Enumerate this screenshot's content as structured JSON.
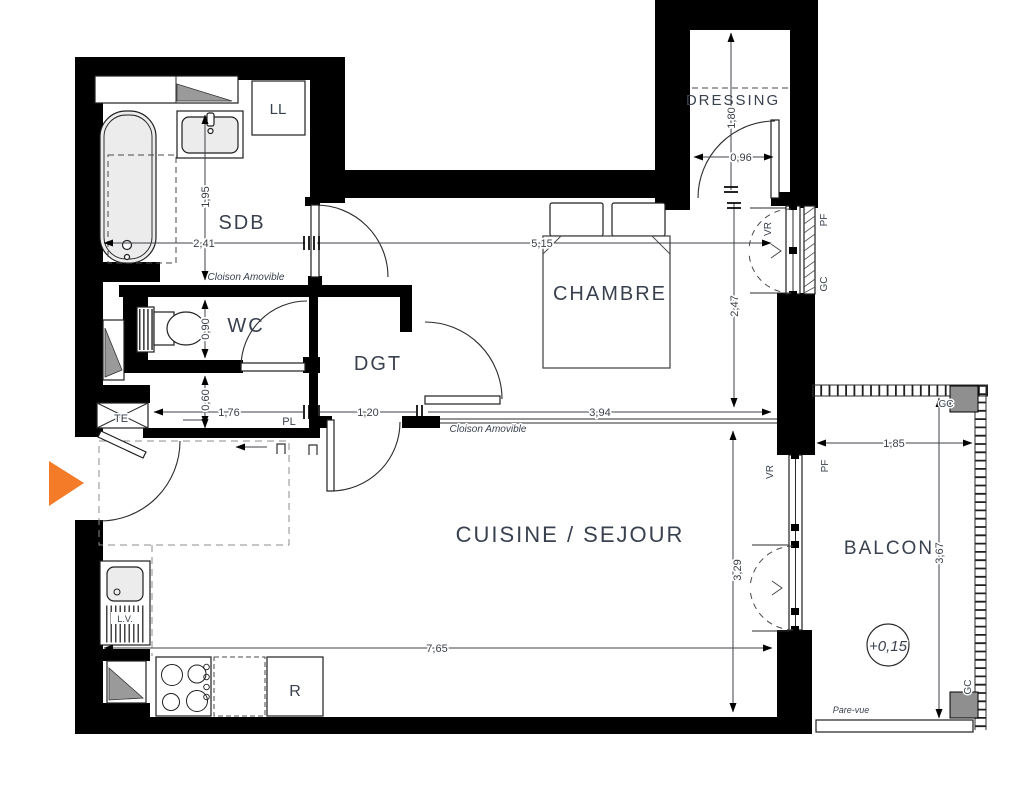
{
  "colors": {
    "wall": "#000000",
    "entry_arrow": "#f47c28",
    "fixture_fill": "#ececec",
    "shaft_fill": "#9a9a9a",
    "post_fill": "#8f8f8f",
    "text": "#39414f",
    "dim_text": "#3a3f47"
  },
  "rooms": {
    "sdb": "SDB",
    "wc": "WC",
    "dgt": "DGT",
    "chambre": "CHAMBRE",
    "dressing": "DRESSING",
    "cuisine_sejour": "CUISINE / SEJOUR",
    "balcon": "BALCON"
  },
  "equipment": {
    "washing_machine": "LL",
    "dishwasher": "L.V.",
    "fridge": "R",
    "electrical_panel": "TE",
    "closet": "PL"
  },
  "openings": {
    "roller_shutter": "VR",
    "french_window": "PF",
    "guardrail": "GC"
  },
  "partitions": {
    "removable_partition": "Cloison Amovible",
    "privacy_screen": "Pare-vue"
  },
  "levels": {
    "balcony_level": "+0,15"
  },
  "dimensions": {
    "sdb_width": "2,41",
    "sdb_depth": "1,95",
    "wc_depth": "0,90",
    "entry_closet_depth": "0,60",
    "entry_closet_width": "1,76",
    "dgt_width": "1,20",
    "chambre_width": "5,15",
    "chambre_depth": "2,47",
    "chambre_south_width": "3,94",
    "dressing_depth": "1,80",
    "dressing_width": "0,96",
    "cuisine_width": "7,65",
    "cuisine_depth": "3,29",
    "balcon_width": "1,85",
    "balcon_depth": "3,67"
  }
}
